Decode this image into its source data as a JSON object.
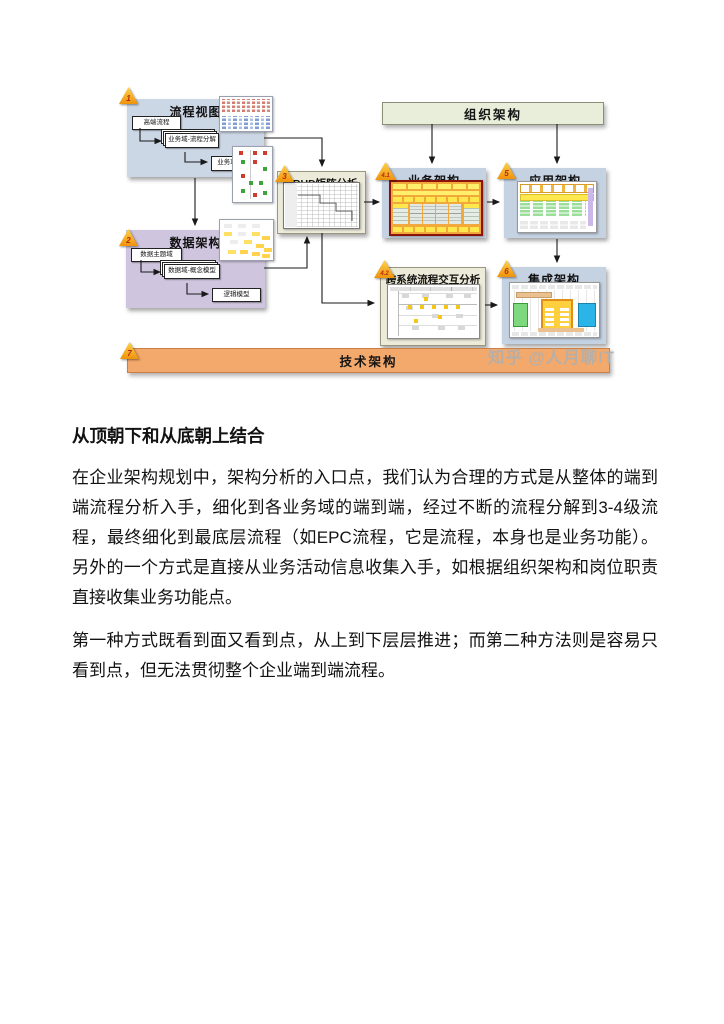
{
  "watermark": "知乎 @人月聊IT",
  "diagram": {
    "process_view": {
      "num": "1",
      "title": "流程视图",
      "steps": [
        "高端流程",
        "业务域-流程分解",
        "业务功能-EPC"
      ]
    },
    "data_arch": {
      "num": "2",
      "title": "数据架构",
      "steps": [
        "数据主题域",
        "数据域-概念模型",
        "逻辑模型"
      ]
    },
    "crud": {
      "num": "3",
      "title": "CRUD矩阵分析"
    },
    "org_arch": {
      "title": "组织架构"
    },
    "biz_arch": {
      "num": "4.1",
      "title": "业务架构"
    },
    "app_arch": {
      "num": "5",
      "title": "应用架构"
    },
    "cross_sys": {
      "num": "4.2",
      "title": "跨系统流程交互分析"
    },
    "int_arch": {
      "num": "6",
      "title": "集成架构"
    },
    "tech_arch": {
      "num": "7",
      "title": "技术架构"
    },
    "colors": {
      "process_blue": "#ccd7e6",
      "data_purple": "#cfc5de",
      "org_green": "#e9eedb",
      "analysis_beige": "#ecead9",
      "arch_blue": "#c5d2e2",
      "tech_orange": "#f4a96c",
      "marker_yellow": "#f9b328"
    }
  },
  "article": {
    "heading": "从顶朝下和从底朝上结合",
    "paragraphs": [
      "在企业架构规划中，架构分析的入口点，我们认为合理的方式是从整体的端到端流程分析入手，细化到各业务域的端到端，经过不断的流程分解到3-4级流程，最终细化到最底层流程（如EPC流程，它是流程，本身也是业务功能）。另外的一个方式是直接从业务活动信息收集入手，如根据组织架构和岗位职责直接收集业务功能点。",
      "第一种方式既看到面又看到点，从上到下层层推进；而第二种方法则是容易只看到点，但无法贯彻整个企业端到端流程。"
    ]
  }
}
